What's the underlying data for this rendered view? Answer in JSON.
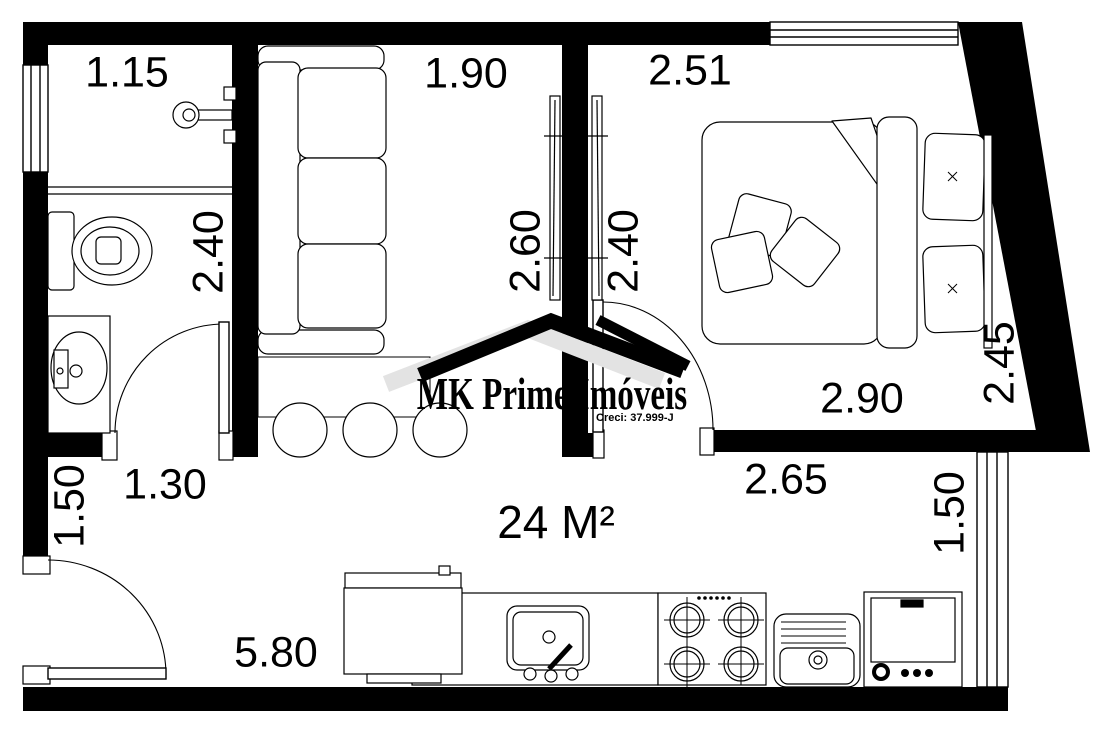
{
  "plan": {
    "area_label": "24 M²",
    "watermark": {
      "brand": "MK Prime Imóveis",
      "license": "Creci: 37.999-J"
    },
    "dimensions": {
      "bathroom_width": "1.15",
      "living_width": "1.90",
      "bedroom_width": "2.51",
      "bathroom_depth": "2.40",
      "living_depth": "2.60",
      "bedroom_depth": "2.40",
      "bedroom_side": "2.45",
      "bedroom_bottom": "2.90",
      "kitchen_top": "2.65",
      "entry_side": "1.50",
      "kitchen_window_side": "1.50",
      "hall_width": "1.30",
      "kitchen_width": "5.80"
    },
    "colors": {
      "wall": "#000000",
      "background": "#ffffff",
      "watermark_gray": "#e3e3e3"
    }
  }
}
